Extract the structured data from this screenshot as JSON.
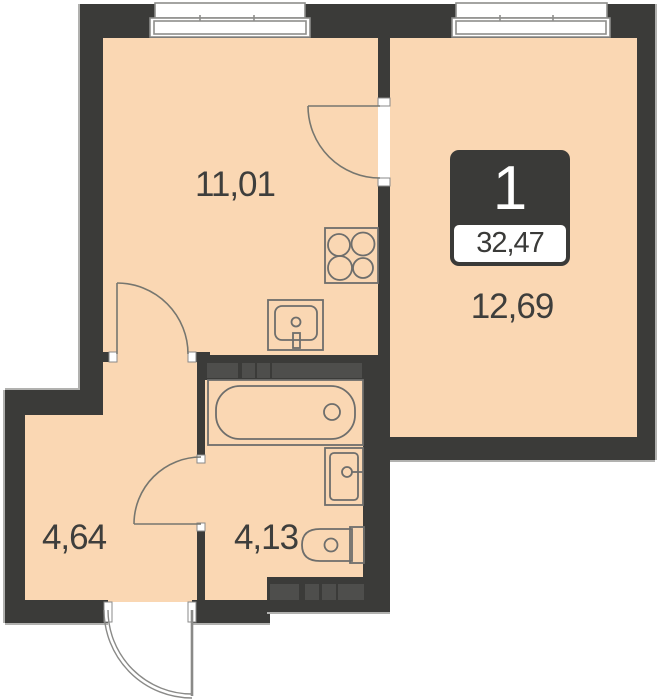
{
  "badge": {
    "number": "1",
    "total_area": "32,47"
  },
  "rooms": [
    {
      "name": "living-kitchen",
      "area": "11,01"
    },
    {
      "name": "bedroom",
      "area": "12,69"
    },
    {
      "name": "hallway",
      "area": "4,64"
    },
    {
      "name": "bathroom",
      "area": "4,13"
    }
  ],
  "fixtures": [
    "stove",
    "kitchen-sink",
    "bathtub",
    "washbasin",
    "toilet"
  ],
  "windows": [
    "window-left",
    "window-right"
  ],
  "doors": [
    "room-door",
    "kitchen-hall-door",
    "bathroom-door",
    "entry-door"
  ],
  "colors": {
    "floor": "#fad7b3",
    "wall": "#3b3b39",
    "vent_block": "#4e4e4c",
    "fixture_stroke": "#6e6e6c",
    "window_stroke": "#8d8d8b",
    "outer_highlight": "#b1b1af",
    "label_text": "#3e3e3c",
    "badge_bg": "#3a3a38"
  }
}
